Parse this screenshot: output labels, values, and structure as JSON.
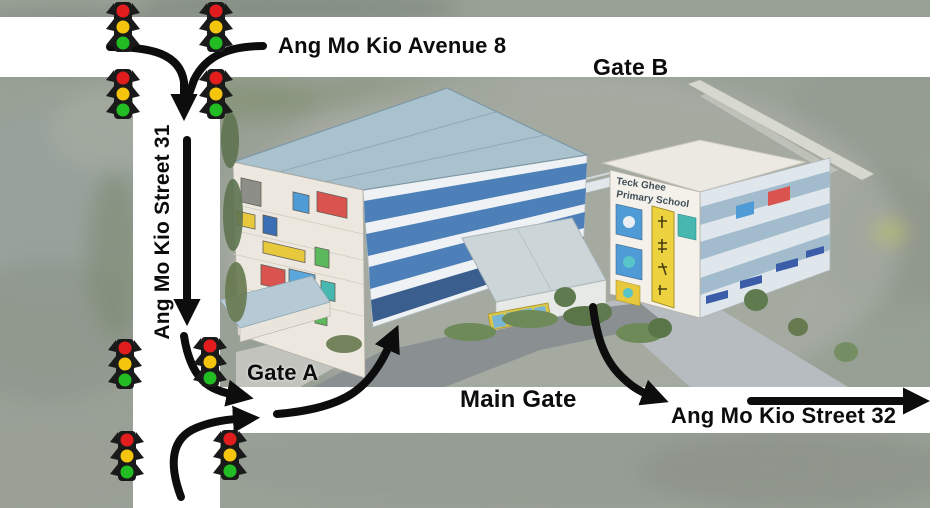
{
  "map": {
    "road_labels": {
      "avenue_8": "Ang Mo Kio Avenue 8",
      "street_31": "Ang Mo Kio Street 31",
      "street_32": "Ang Mo Kio Street 32"
    },
    "gate_labels": {
      "gate_a": "Gate A",
      "gate_b": "Gate B",
      "main_gate": "Main Gate"
    },
    "school_sign": {
      "line1": "Teck Ghee",
      "line2": "Primary School"
    },
    "traffic_light_count": 8,
    "icons": {
      "traffic_light": "traffic-light-icon",
      "direction_arrow": "direction-arrow",
      "chinese_banner": "chinese-script-banner-icon"
    },
    "colors": {
      "road_white": "#ffffff",
      "arrow_black": "#0d0d0d",
      "traffic_red": "#e21d1d",
      "traffic_yellow": "#f5c40c",
      "traffic_green": "#22bd22",
      "terrain_gray_green": "#99a096",
      "roof_blue_gray": "#a9c2ce",
      "facade_band_blue": "#4d7fb8",
      "tile_red": "#d9534f",
      "tile_blue": "#4f9bd6",
      "tile_yellow": "#e8c93e",
      "tile_green": "#5cb85c"
    }
  }
}
